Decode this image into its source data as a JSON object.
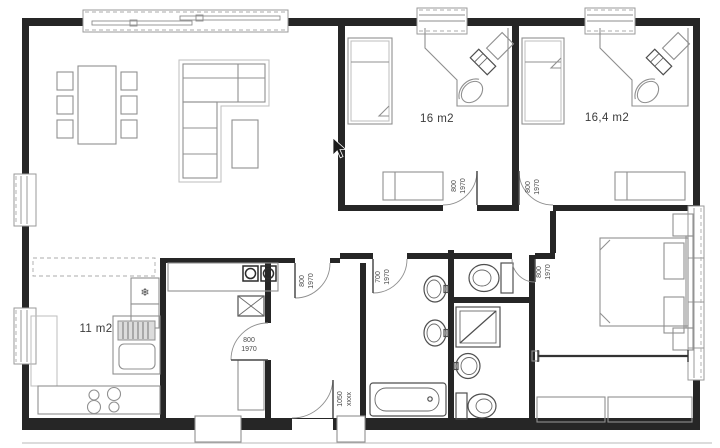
{
  "plan": {
    "rooms": {
      "bedroom1": {
        "label": "16 m2"
      },
      "bedroom2": {
        "label": "16,4 m2"
      },
      "kitchen": {
        "label": "11 m2"
      }
    },
    "doors": {
      "bedroom1": {
        "w": "800",
        "h": "1970"
      },
      "bedroom2": {
        "w": "800",
        "h": "1970"
      },
      "hall_living": {
        "w": "800",
        "h": "1970"
      },
      "pantry": {
        "w": "800",
        "h": "1970"
      },
      "bathroom": {
        "w": "700",
        "h": "1970"
      },
      "wc": {
        "w": "800",
        "h": "1970"
      },
      "entry": {
        "w": "1050",
        "h": "xxxx"
      }
    },
    "icons": {
      "freezer_snowflake": "❄"
    },
    "palette": {
      "wall": "#262626",
      "furniture_line": "#909090",
      "fixture_line": "#4f4f4f"
    }
  }
}
